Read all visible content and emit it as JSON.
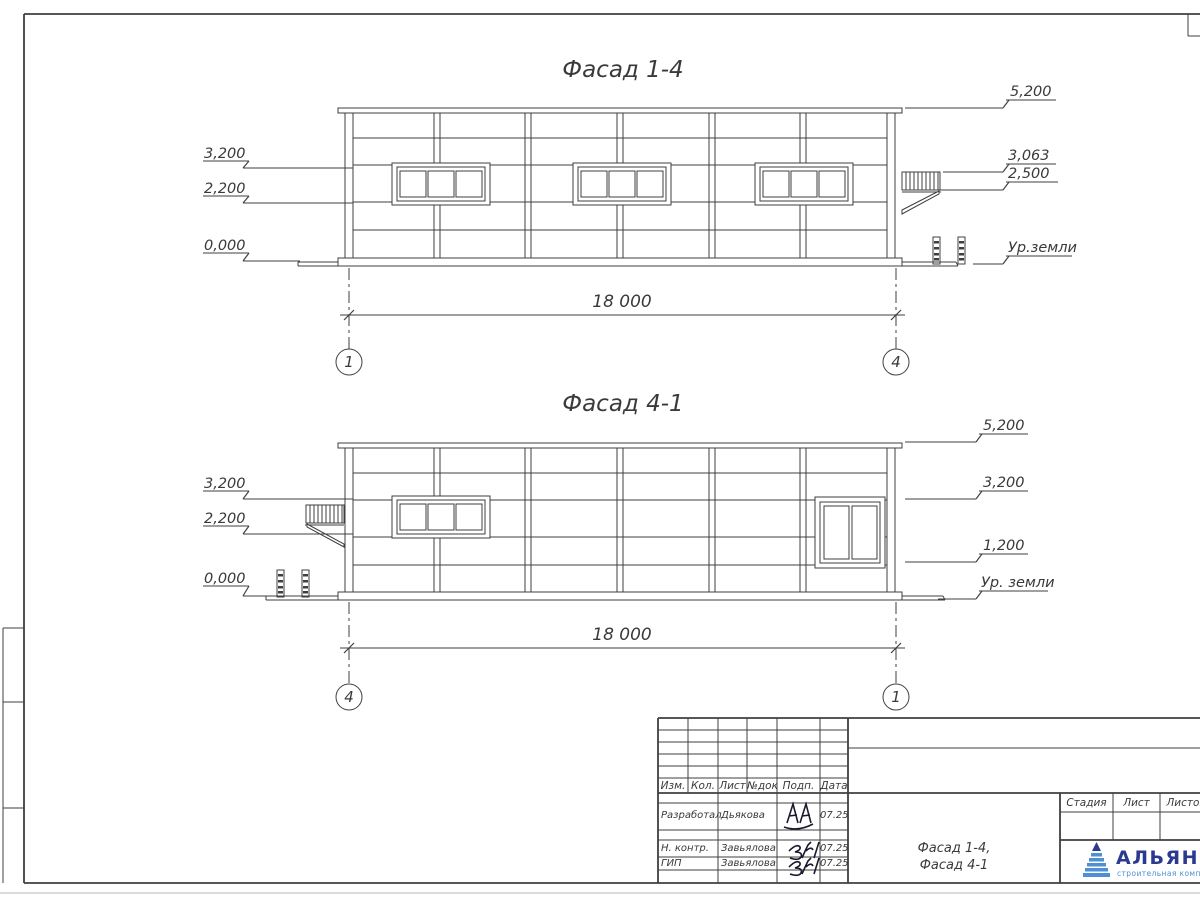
{
  "sheet": {
    "facades": [
      {
        "title": "Фасад 1-4",
        "dimension": "18 000",
        "axis_left": "1",
        "axis_right": "4",
        "marks_left": [
          "3,200",
          "2,200",
          "0,000"
        ],
        "marks_right": [
          "5,200",
          "3,063",
          "2,500",
          "Ур.земли"
        ]
      },
      {
        "title": "Фасад 4-1",
        "dimension": "18 000",
        "axis_left": "4",
        "axis_right": "1",
        "marks_left": [
          "3,200",
          "2,200",
          "0,000"
        ],
        "marks_right": [
          "5,200",
          "3,200",
          "1,200",
          "Ур. земли"
        ]
      }
    ],
    "title_block": {
      "header_cols": [
        "Изм.",
        "Кол.",
        "Лист",
        "№док",
        "Подп.",
        "Дата"
      ],
      "sign_rows": [
        {
          "role": "Разработал",
          "name": "Дьякова",
          "date": "07.25"
        },
        {
          "role": "Н. контр.",
          "name": "Завьялова",
          "date": "07.25"
        },
        {
          "role": "ГИП",
          "name": "Завьялова",
          "date": "07.25"
        }
      ],
      "doc_title": [
        "Фасад 1-4,",
        "Фасад 4-1"
      ],
      "stage_cols": [
        "Стадия",
        "Лист",
        "Листов"
      ],
      "logo_name": "АЛЬЯНС",
      "logo_subtitle": "строительная компания"
    },
    "colors": {
      "line": "#3f3f3f",
      "logo_dark": "#2b3990",
      "logo_light": "#4f8fd3"
    }
  }
}
